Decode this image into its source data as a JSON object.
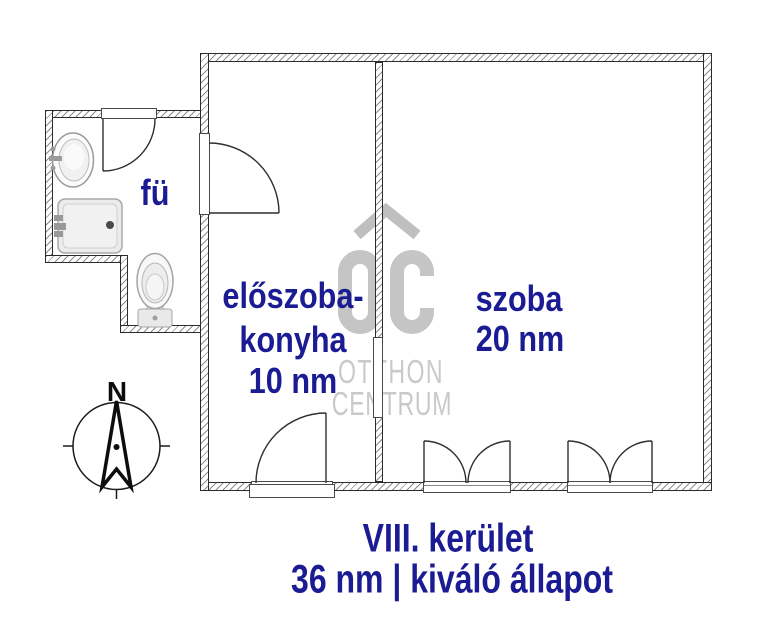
{
  "rooms": {
    "bathroom": {
      "label": "fü"
    },
    "hall_kitchen": {
      "line1": "előszoba-",
      "line2": "konyha",
      "line3": "10 nm"
    },
    "room": {
      "line1": "szoba",
      "line2": "20 nm"
    }
  },
  "compass": {
    "north_label": "N"
  },
  "watermark": {
    "logo_text": "OC",
    "name_line1": "OTTHON",
    "name_line2": "CENTRUM"
  },
  "footer": {
    "district": "VIII. kerület",
    "details": "36 nm | kiváló állapot"
  },
  "colors": {
    "label_blue": "#1b1b94",
    "watermark_gray": "#c5c5c5",
    "line_dark": "#2f2f2f"
  }
}
